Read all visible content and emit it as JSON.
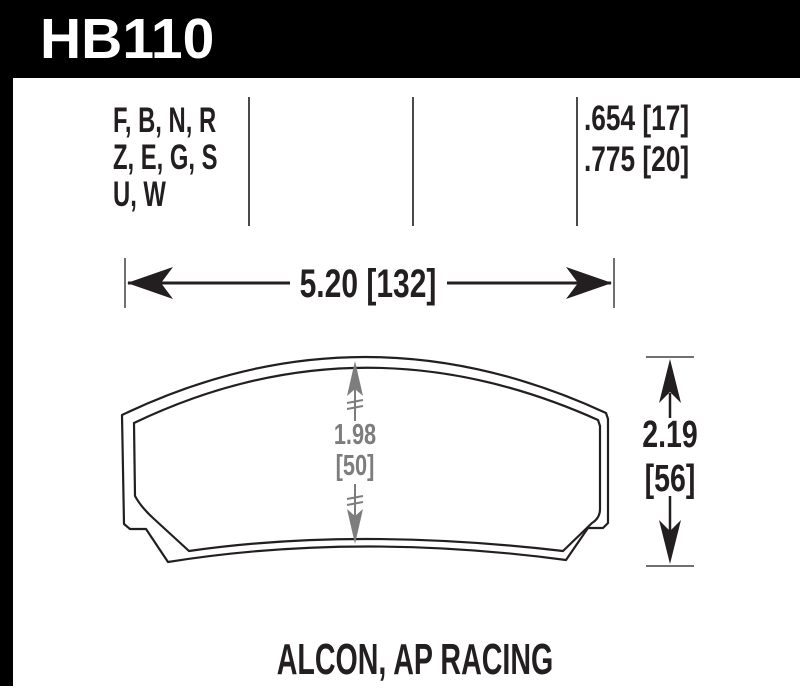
{
  "part": {
    "number": "HB110"
  },
  "compound_codes": {
    "lines": [
      "F, B, N, R",
      "Z, E, G, S",
      "U, W"
    ]
  },
  "pad_thickness": {
    "lines": [
      ".654 [17]",
      ".775 [20]"
    ]
  },
  "dimensions": {
    "width": {
      "label": "5.20 [132]"
    },
    "pad_height": {
      "value": "1.98",
      "metric": "[50]",
      "color": "#7d7d7d"
    },
    "overall_height": {
      "value": "2.19",
      "metric": "[56]"
    }
  },
  "footer": {
    "applications": "ALCON, AP RACING"
  },
  "colors": {
    "header_bg": "#000000",
    "header_text": "#ffffff",
    "ink": "#231f20",
    "column_separator": "#4a4a4a",
    "dimension_tick": "#707070",
    "dimension_gray": "#7d7d7d",
    "background": "#ffffff"
  }
}
